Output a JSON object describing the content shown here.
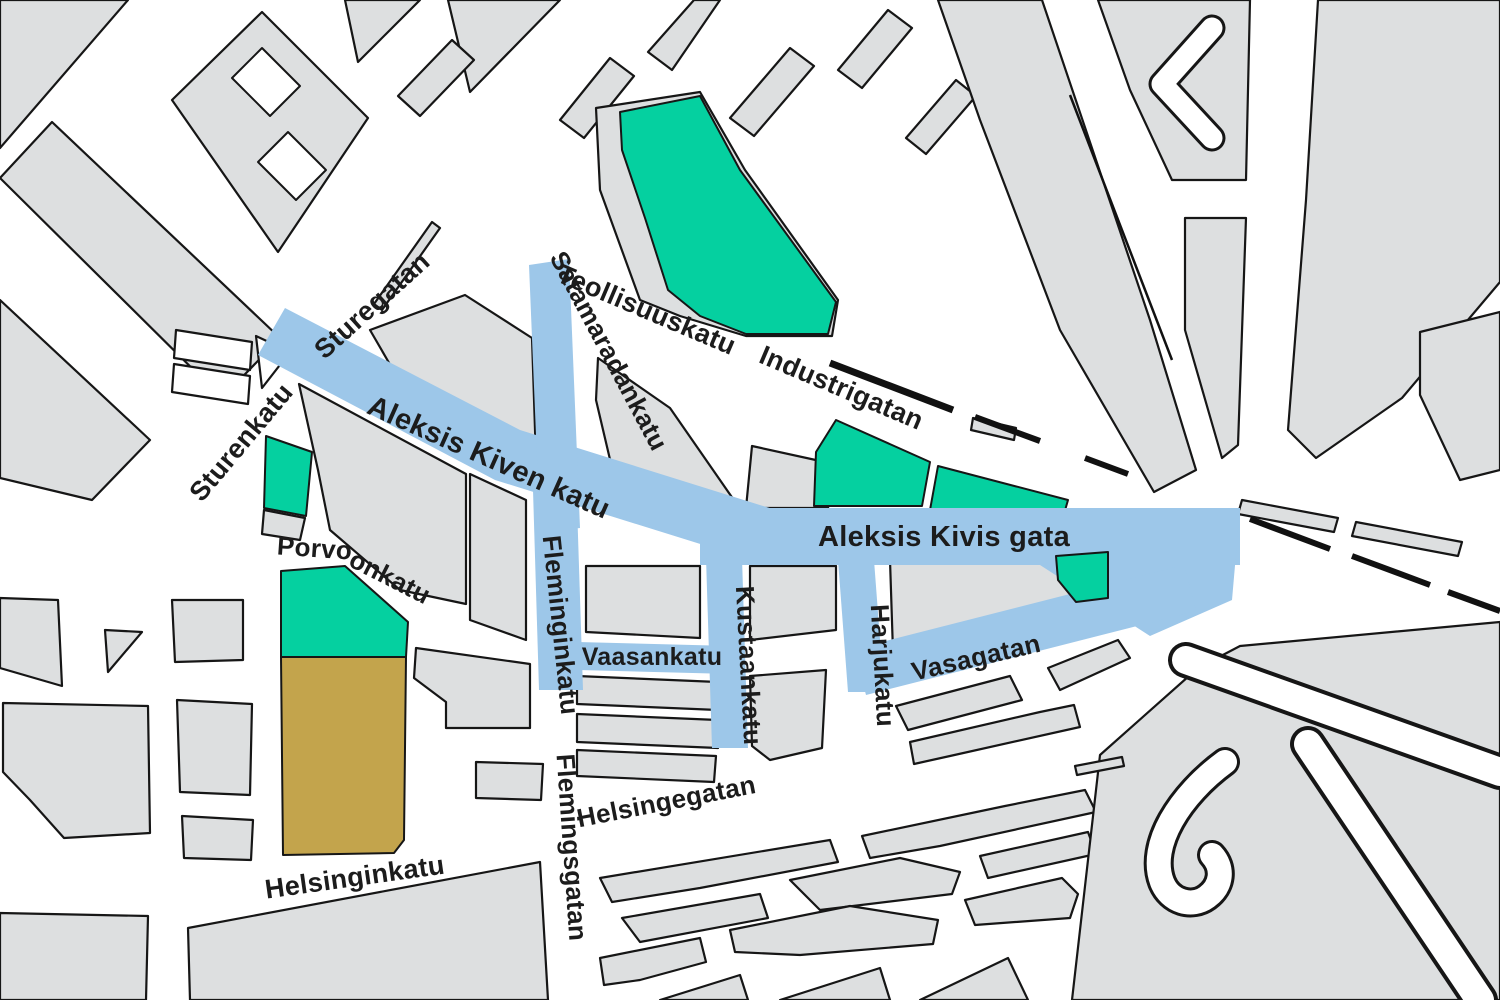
{
  "map": {
    "type": "street-map",
    "description_visible_text_only": true,
    "colors": {
      "background": "#ffffff",
      "block": "#dddfe0",
      "outline": "#161616",
      "highlight_blue": "#9dc7e9",
      "park_green": "#05d0a0",
      "field_tan": "#c3a44c",
      "railway_black": "#111111",
      "label": "#1c1c1c"
    },
    "labels": [
      {
        "id": "sturegatan",
        "text": "Sturegatan",
        "x": 378,
        "y": 312,
        "rotate": -42,
        "size": 27
      },
      {
        "id": "sturenkatu",
        "text": "Sturenkatu",
        "x": 248,
        "y": 448,
        "rotate": -50,
        "size": 27
      },
      {
        "id": "teollisuuskatu",
        "text": "Teollisuuskatu",
        "x": 643,
        "y": 318,
        "rotate": 23,
        "size": 27
      },
      {
        "id": "satamaradankatu",
        "text": "Satamaradankatu",
        "x": 601,
        "y": 355,
        "rotate": 62,
        "size": 26
      },
      {
        "id": "industrigatan",
        "text": "Industrigatan",
        "x": 838,
        "y": 396,
        "rotate": 23,
        "size": 27
      },
      {
        "id": "aleksis-kiven-katu",
        "text": "Aleksis Kiven katu",
        "x": 485,
        "y": 466,
        "rotate": 24,
        "size": 29
      },
      {
        "id": "aleksis-kivis-gata",
        "text": "Aleksis Kivis gata",
        "x": 944,
        "y": 546,
        "rotate": 0,
        "size": 29
      },
      {
        "id": "porvoonkatu-a",
        "text": "Porvo",
        "x": 314,
        "y": 557,
        "rotate": 4,
        "size": 26
      },
      {
        "id": "porvoonkatu-b",
        "text": "onkatu",
        "x": 386,
        "y": 585,
        "rotate": 27,
        "size": 26
      },
      {
        "id": "fleminginkatu",
        "text": "Fleminginkatu",
        "x": 552,
        "y": 626,
        "rotate": 84,
        "size": 26
      },
      {
        "id": "vaasankatu",
        "text": "Vaasankatu",
        "x": 652,
        "y": 665,
        "rotate": 0,
        "size": 25
      },
      {
        "id": "kustaankatu",
        "text": "Kustaankatu",
        "x": 740,
        "y": 666,
        "rotate": 87,
        "size": 26
      },
      {
        "id": "harjukatu",
        "text": "Harjukatu",
        "x": 874,
        "y": 666,
        "rotate": 87,
        "size": 26
      },
      {
        "id": "vasagatan",
        "text": "Vasagatan",
        "x": 978,
        "y": 666,
        "rotate": -13,
        "size": 26
      },
      {
        "id": "helsingegatan",
        "text": "Helsingegatan",
        "x": 668,
        "y": 810,
        "rotate": -11,
        "size": 26
      },
      {
        "id": "flemingsgatan",
        "text": "Flemingsgatan",
        "x": 563,
        "y": 848,
        "rotate": 86,
        "size": 26
      },
      {
        "id": "helsinginkatu",
        "text": "Helsinginkatu",
        "x": 356,
        "y": 886,
        "rotate": -8,
        "size": 27
      }
    ]
  }
}
